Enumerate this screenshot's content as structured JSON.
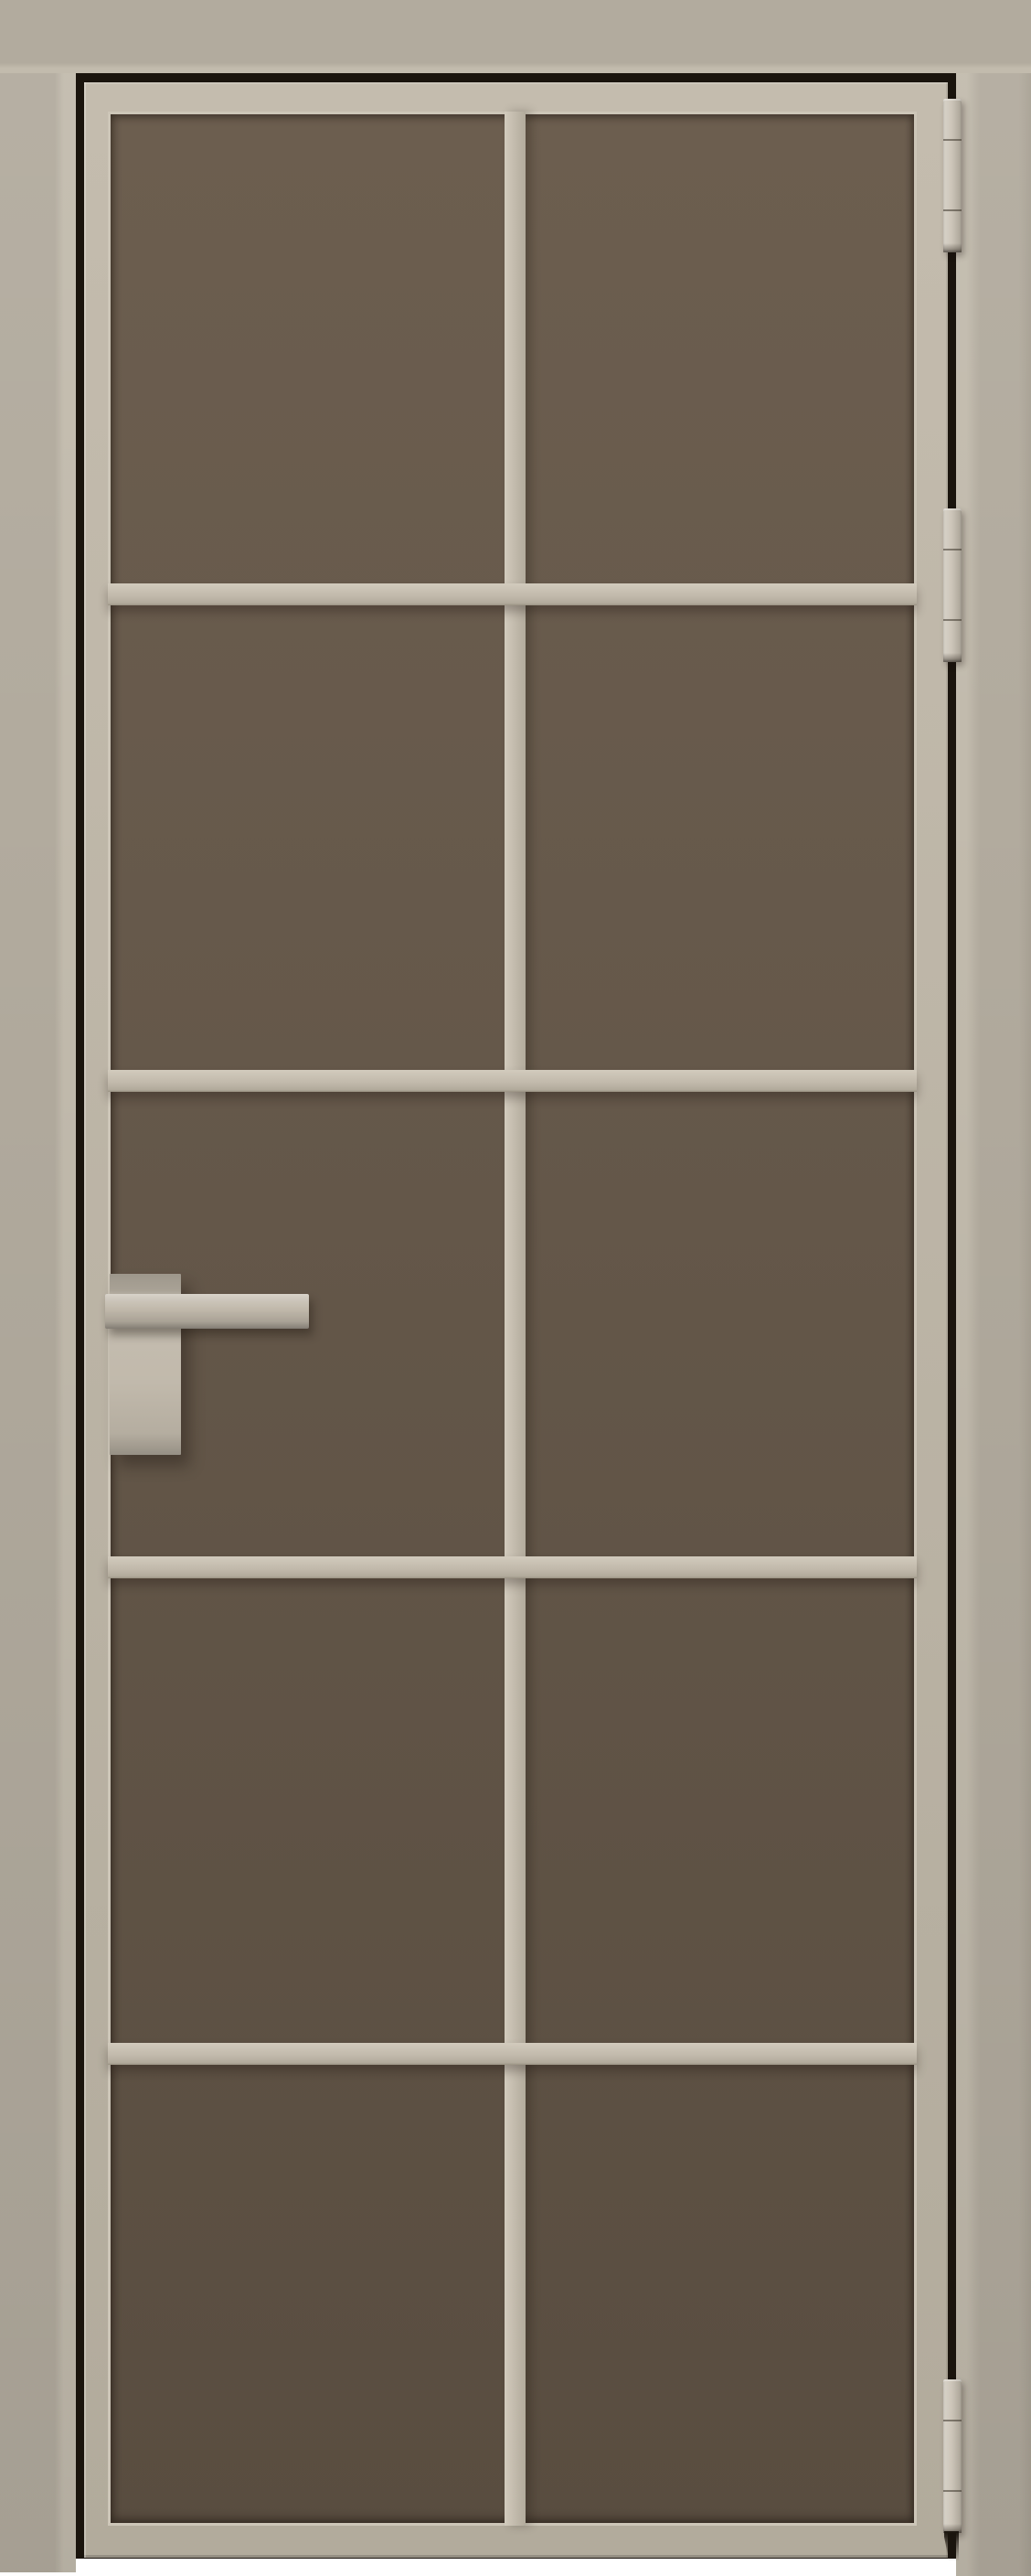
{
  "image": {
    "kind": "3d product render",
    "subject": "single-leaf interior glass door in its frame, closed, front elevation",
    "background": "plain white studio background"
  },
  "door": {
    "frame": {
      "casing_finish": "matte sand / stucco painted aluminum architrave",
      "reveal": "dark shadow gap between casing and leaf on top, left and right sides"
    },
    "leaf": {
      "profile_finish": "matte sand / stucco aluminum profile",
      "glass_tint": "bronze-brown tinted satin glass",
      "grid": {
        "panel_rows": 5,
        "panel_columns": 2,
        "panel_count": 10,
        "horizontal_muntins": 4,
        "vertical_muntins": 1
      }
    },
    "hardware": {
      "handle": {
        "type": "square lever handle on tall rectangular backplate",
        "mounted_side": "left stile",
        "finish": "matching sand"
      },
      "hinges": {
        "count": 3,
        "type": "surface-mounted barrel hinges",
        "mounted_side": "right",
        "positions": [
          "top",
          "upper-middle",
          "bottom"
        ]
      }
    }
  },
  "colors": {
    "background": "#ffffff",
    "casing": "#b2ab9e",
    "casing-shade": "#a8a194",
    "casing-bevel": "#c2bbad",
    "reveal": "#1a140d",
    "leaf": "#c4bcae",
    "leaf-shade": "#b2ab9c",
    "bead": "#cdc6b8",
    "muntin-hi": "#d2cbbd",
    "muntin": "#c2baac",
    "muntin-lo": "#9a9283",
    "glass-top": "#6c5e4f",
    "glass-mid": "#65584a",
    "glass-bottom": "#594d40",
    "hinge": "#c6beb0",
    "handle": "#c0b8aa"
  }
}
